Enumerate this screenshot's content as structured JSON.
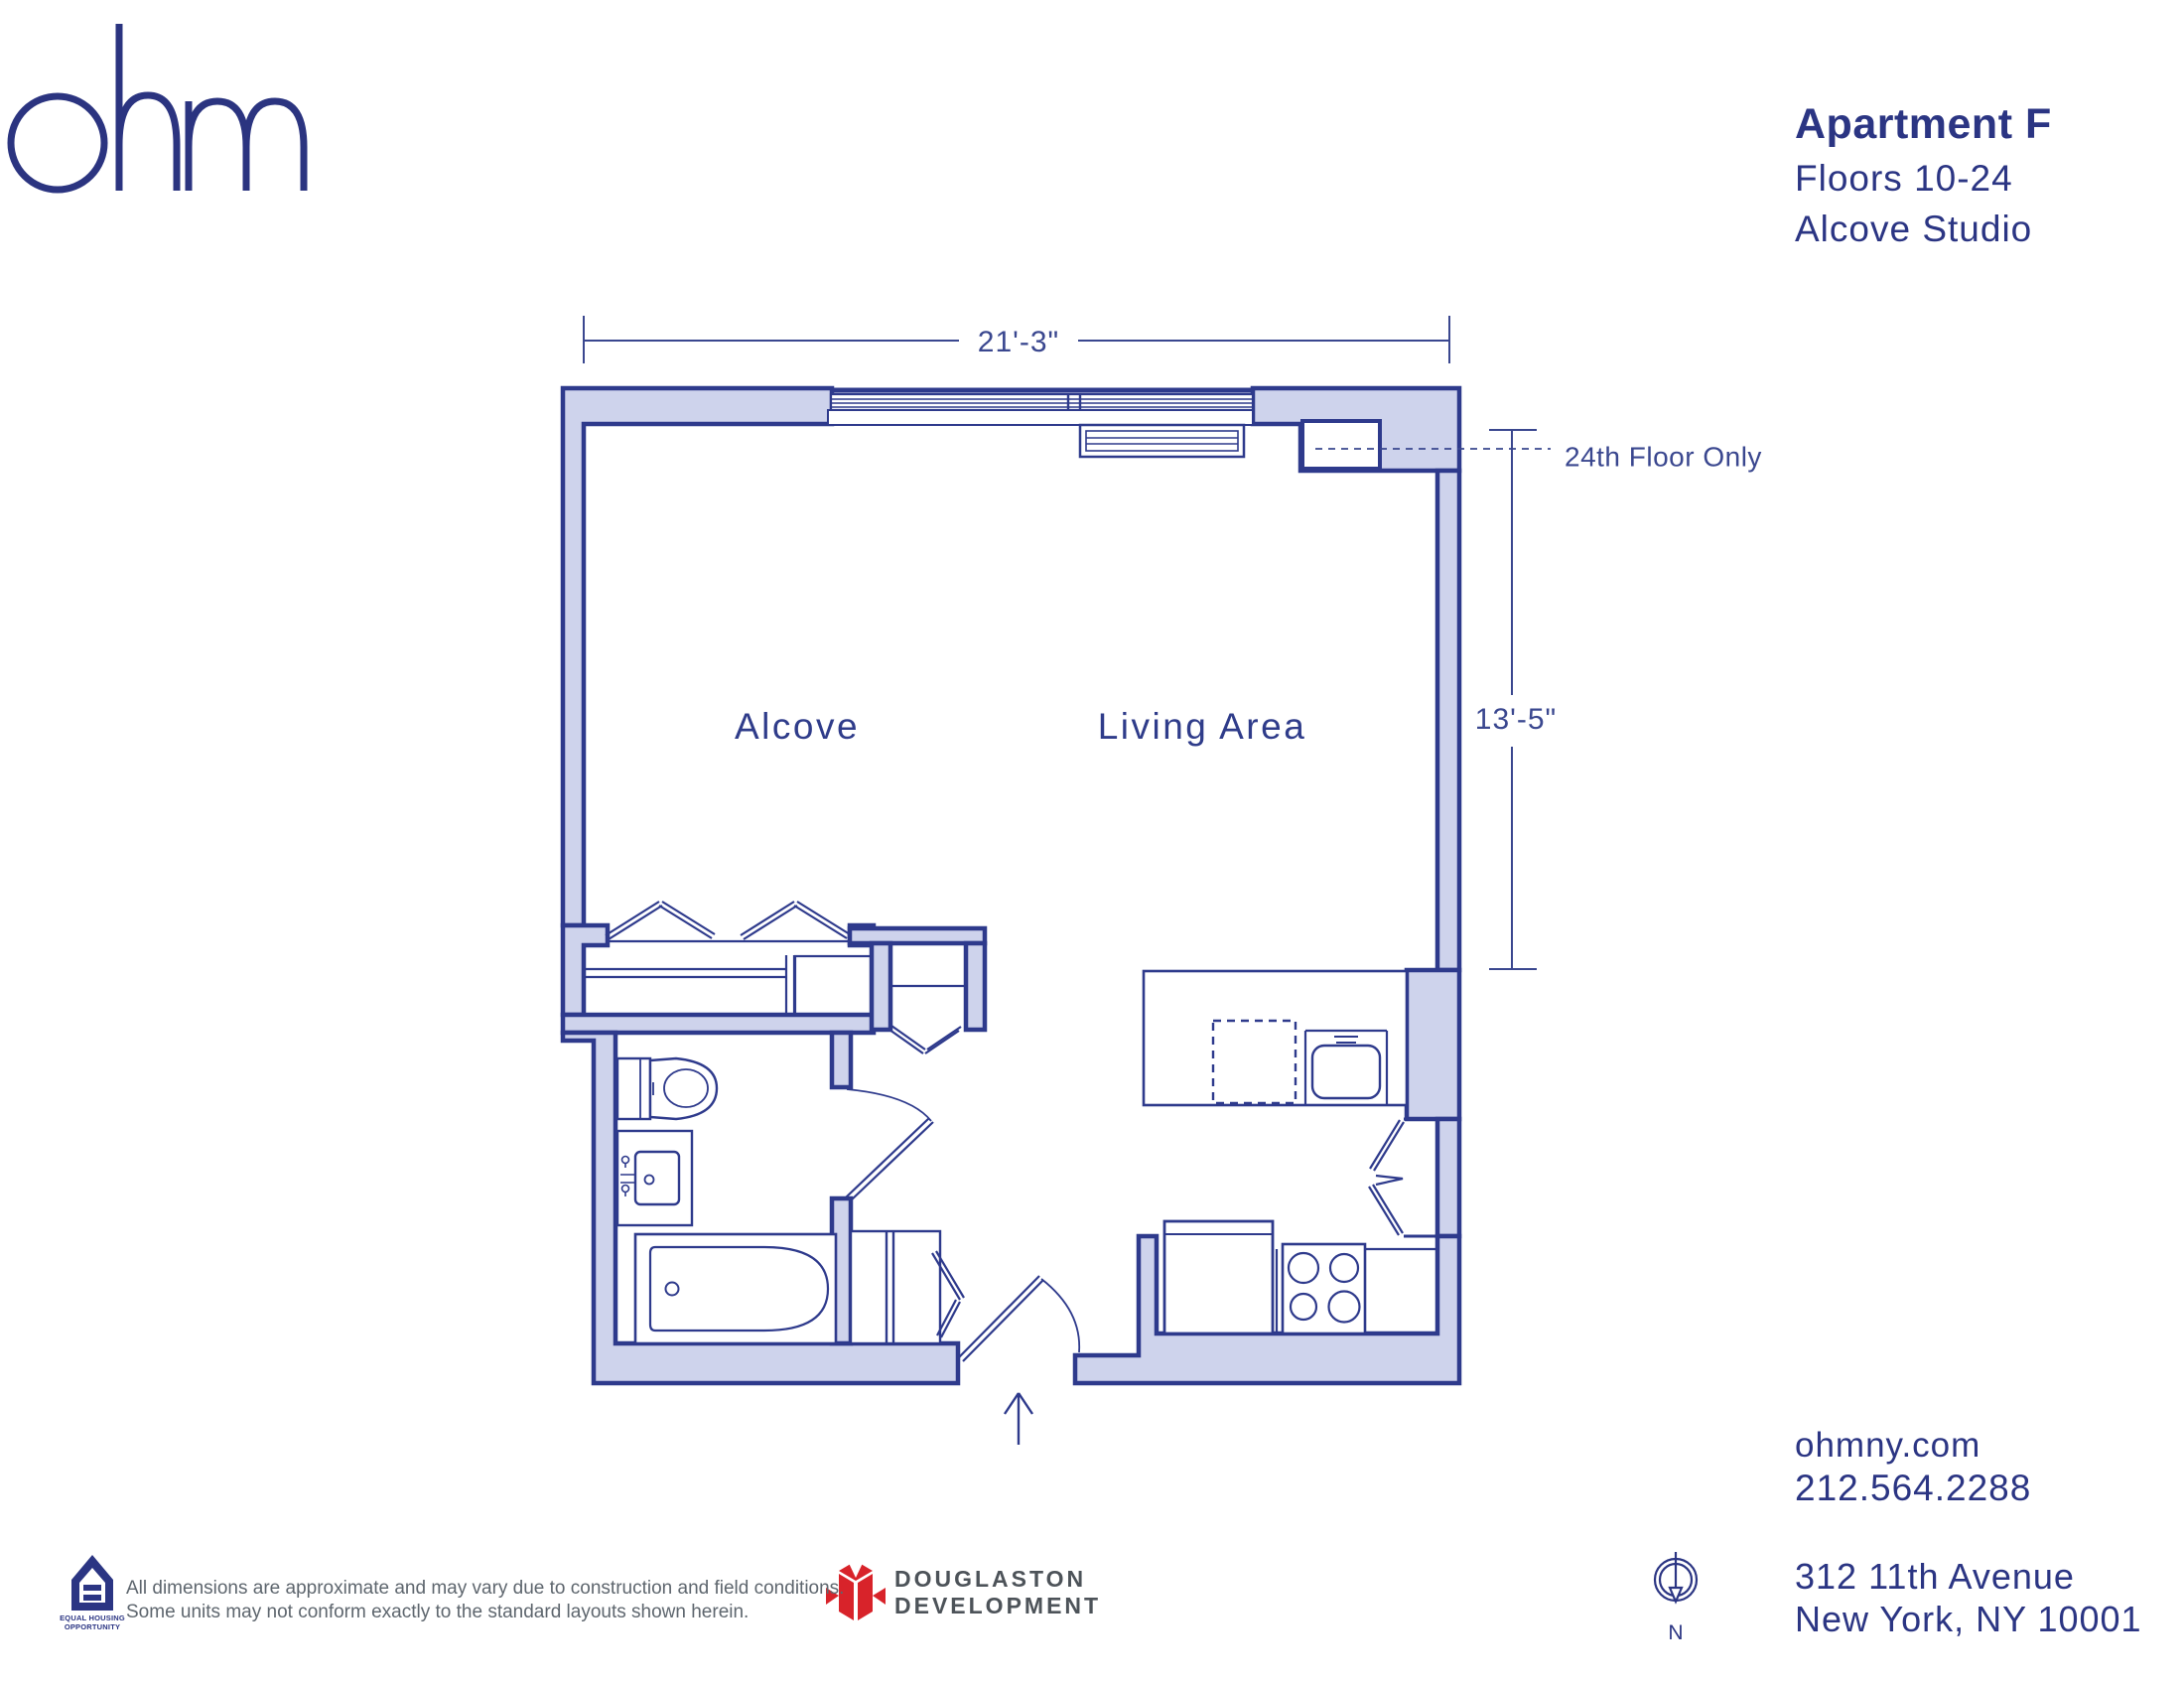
{
  "branding": {
    "logo_text": "ohm"
  },
  "title_block": {
    "apartment": "Apartment F",
    "floors": "Floors 10-24",
    "unit_type": "Alcove Studio"
  },
  "plan": {
    "room_labels": {
      "alcove": "Alcove",
      "living_area": "Living Area"
    },
    "dimensions": {
      "width": "21'-3\"",
      "depth": "13'-5\""
    },
    "annotation": {
      "floor_note": "24th Floor Only"
    },
    "compass": {
      "north_label": "N"
    }
  },
  "footer": {
    "eho": {
      "line1": "EQUAL HOUSING",
      "line2": "OPPORTUNITY"
    },
    "disclaimer": {
      "line1": "All dimensions are approximate and may vary due to construction and field conditions.",
      "line2": "Some units may not conform exactly to the standard layouts shown herein."
    },
    "developer": {
      "line1": "DOUGLASTON",
      "line2": "DEVELOPMENT"
    },
    "contact": {
      "website": "ohmny.com",
      "phone": "212.564.2288"
    },
    "address": {
      "line1": "312 11th Avenue",
      "line2": "New York, NY 10001"
    }
  },
  "colors": {
    "navy": "#2b3583",
    "wall_fill": "#ced3ec",
    "line": "#2e3a8c",
    "red": "#d8232a",
    "text_gray": "#5e666e",
    "dev_gray": "#4d5359"
  }
}
